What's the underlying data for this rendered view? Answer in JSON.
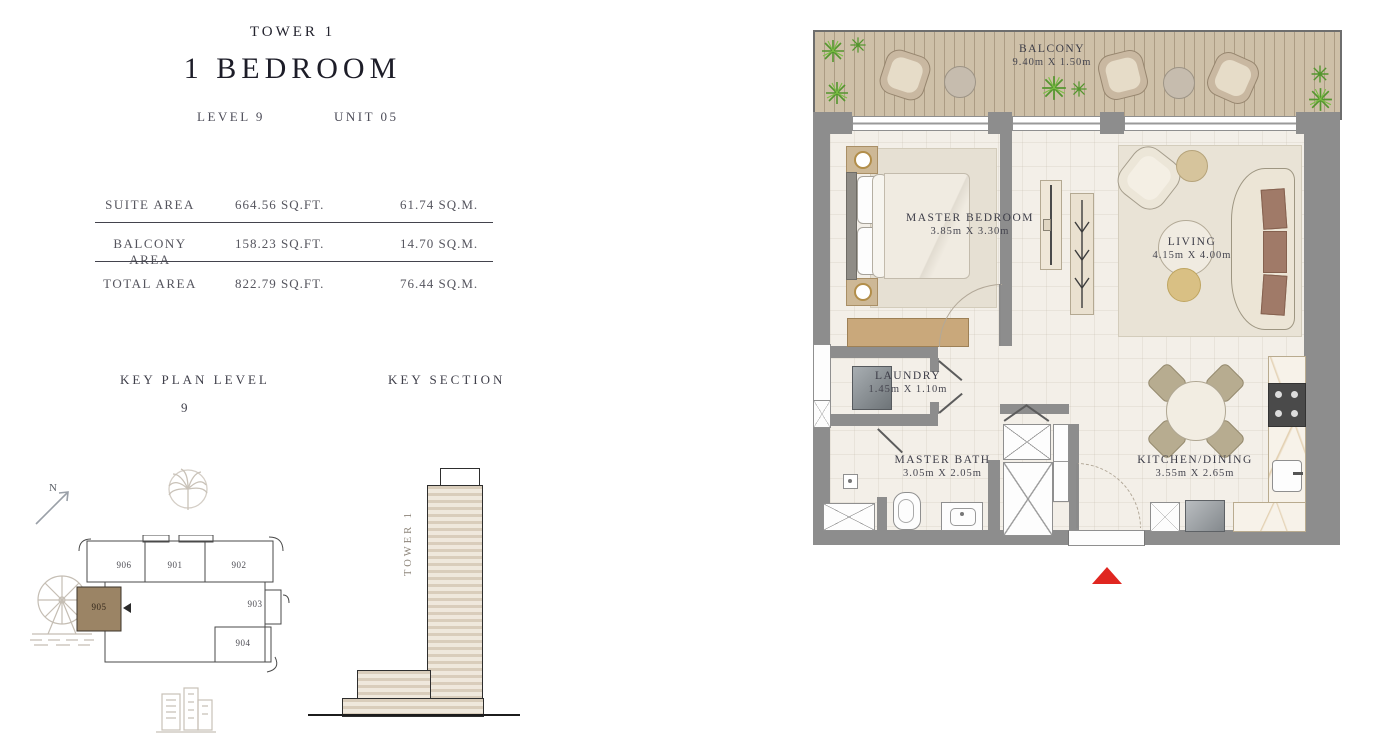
{
  "header": {
    "tower": "TOWER 1",
    "unit_type": "1 BEDROOM",
    "level": "LEVEL 9",
    "unit": "UNIT 05"
  },
  "area_table": {
    "rows": [
      {
        "label": "SUITE AREA",
        "sqft": "664.56 SQ.FT.",
        "sqm": "61.74 SQ.M."
      },
      {
        "label": "BALCONY AREA",
        "sqft": "158.23 SQ.FT.",
        "sqm": "14.70 SQ.M."
      },
      {
        "label": "TOTAL AREA",
        "sqft": "822.79 SQ.FT.",
        "sqm": "76.44 SQ.M."
      }
    ]
  },
  "key_plan": {
    "title": "KEY PLAN LEVEL",
    "level": "9",
    "north": "N",
    "units": [
      "906",
      "901",
      "902",
      "903",
      "904",
      "905"
    ],
    "highlighted_unit": "905"
  },
  "key_section": {
    "title": "KEY SECTION",
    "tower_label": "TOWER 1"
  },
  "floor_plan": {
    "rooms": {
      "balcony": {
        "name": "BALCONY",
        "dims": "9.40m X 1.50m"
      },
      "master_bedroom": {
        "name": "MASTER BEDROOM",
        "dims": "3.85m X 3.30m"
      },
      "living": {
        "name": "LIVING",
        "dims": "4.15m X 4.00m"
      },
      "laundry": {
        "name": "LAUNDRY",
        "dims": "1.45m X 1.10m"
      },
      "master_bath": {
        "name": "MASTER BATH",
        "dims": "3.05m X 2.05m"
      },
      "kitchen_dining": {
        "name": "KITCHEN/DINING",
        "dims": "3.55m X 2.65m"
      }
    }
  },
  "colors": {
    "accent_red": "#e02620",
    "wall_gray": "#8d8d8d",
    "highlight_brown": "#9b8465",
    "deck_wood": "#cec0a8",
    "plant_green": "#54962e"
  }
}
